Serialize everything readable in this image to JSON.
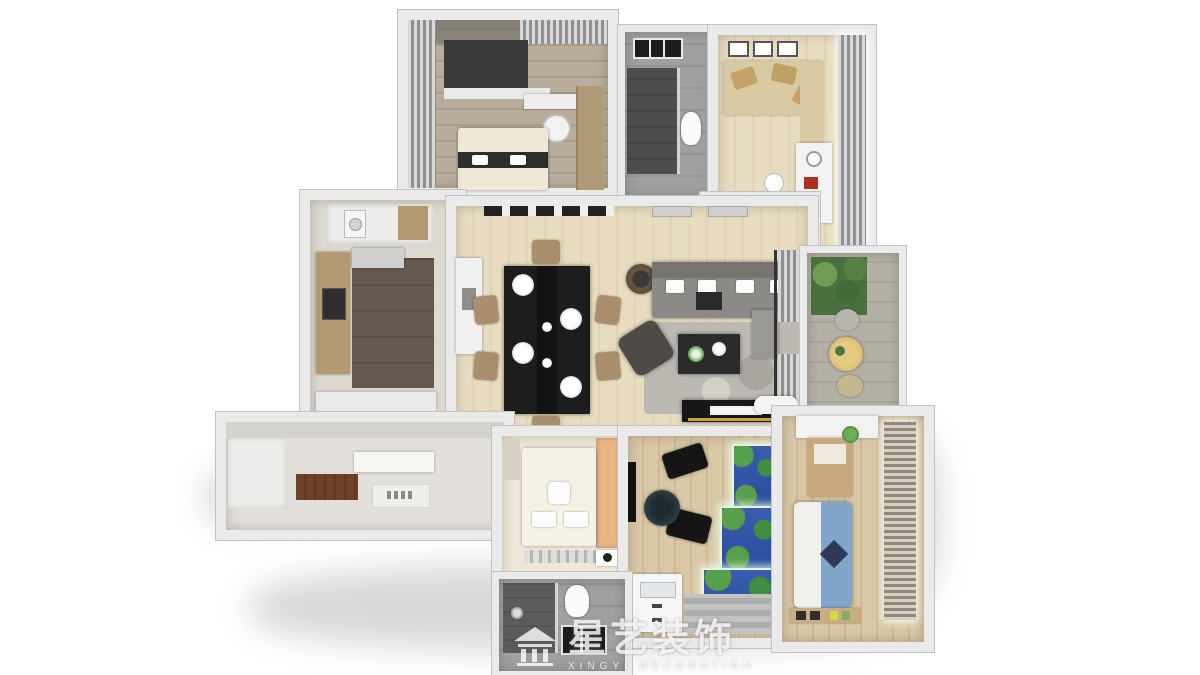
{
  "brand": {
    "logo": "pavilion-house-icon",
    "name_cn": "星艺装饰",
    "name_en": "XINGYI DECORATION"
  },
  "scene": {
    "type": "3d-floorplan-top-down-render",
    "background": "#ffffff"
  },
  "palette": {
    "wall": "#eaeaea",
    "wallEdge": "#c2c2c2",
    "woodLight": "#e8dcc0",
    "woodMid": "#d9c7a6",
    "woodDark": "#b8ad9a",
    "tileDark": "#6e6156",
    "grayFloor": "#a0a09e",
    "rug": "#bcb9b3",
    "sofa": "#8c8a86",
    "ink": "#1d1d1d",
    "paper": "#f4f4f4",
    "peach": "#e8b484",
    "bedBlue": "#7fa6c9",
    "aquaBlue": "#2b4c9c",
    "leaf": "#4a7a40",
    "tan": "#a98f6e",
    "stone": "#b5b0a6",
    "cream": "#efe8d8",
    "shadow": "#d8d8d8"
  },
  "rooms": [
    {
      "id": "master-bedroom",
      "floor": "#b8ad9a"
    },
    {
      "id": "bathroom-top",
      "floor": "#a0a09e"
    },
    {
      "id": "study-room",
      "floor": "#e8dcc0"
    },
    {
      "id": "hallway",
      "floor": "#e8dcc0"
    },
    {
      "id": "kitchen",
      "floor": "#6e6156"
    },
    {
      "id": "dining-living-room",
      "floor": "#e8dcc0"
    },
    {
      "id": "balcony",
      "floor": "#b5b0a6"
    },
    {
      "id": "entry-corridor",
      "floor": "#e2dfda"
    },
    {
      "id": "small-bedroom",
      "floor": "#efe8d8"
    },
    {
      "id": "aquarium-room",
      "floor": "#d9c7a6"
    },
    {
      "id": "kids-bedroom",
      "floor": "#d9c7a6"
    },
    {
      "id": "bathroom-bottom",
      "floor": "#a0a09e"
    }
  ]
}
